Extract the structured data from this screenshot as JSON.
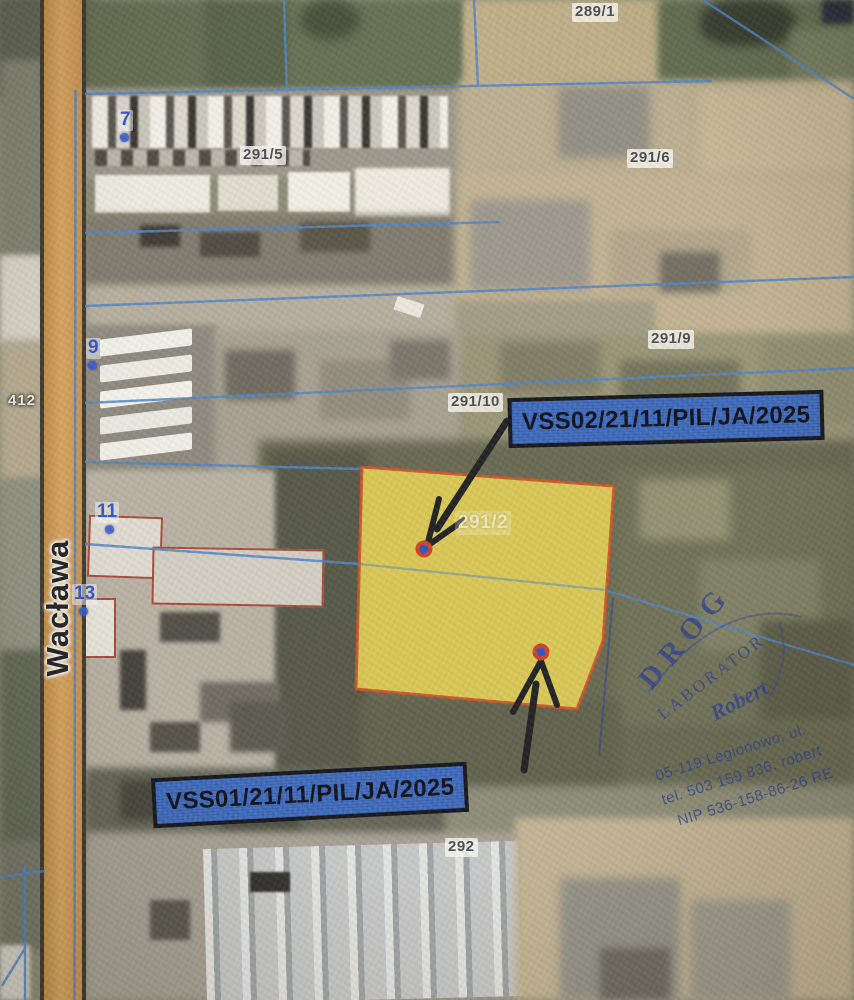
{
  "map": {
    "parcels": {
      "p289_1": "289/1",
      "p291_5": "291/5",
      "p291_6": "291/6",
      "p291_9": "291/9",
      "p291_10": "291/10",
      "p291_2": "291/2",
      "p292": "292"
    },
    "road": {
      "number": "412",
      "street_name": "Wacława"
    },
    "addresses": {
      "a7": "7",
      "a9": "9",
      "a11": "11",
      "a13": "13"
    },
    "measurement_points": {
      "vss02": {
        "label": "VSS02/21/11/PIL/JA/2025"
      },
      "vss01": {
        "label": "VSS01/21/11/PIL/JA/2025"
      }
    },
    "stamp": {
      "company": "DROG",
      "dept": "LABORATOR",
      "signature": "Robert",
      "address": "05-119 Legionowo, ul.",
      "phone": "tel. 503 159 836; robert",
      "tax_id": "NIP 536-158-86-26 RE"
    },
    "colors": {
      "highlight_fill": "#e4cf52",
      "highlight_border": "#c94e22",
      "marker_label_bg": "#3d6dc6",
      "boundary_line": "#4d82c8",
      "road_fill": "#d6953f",
      "stamp_ink": "#2b3f92",
      "point_fill": "#2b4fc0",
      "point_ring": "#cf3f1e"
    }
  }
}
